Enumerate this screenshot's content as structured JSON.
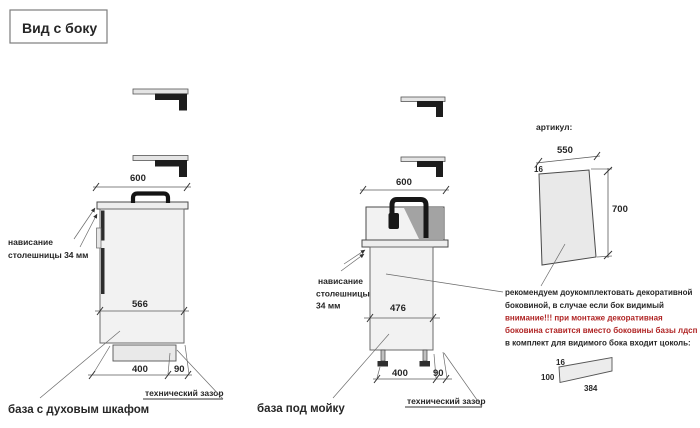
{
  "title": "Вид с боку",
  "colors": {
    "background": "#ffffff",
    "ink": "#262626",
    "warning_red": "#b02525",
    "drawing_line": "#4a4a4a",
    "cabinet_fill": "#f2f2f2",
    "dark_parts": "#1d1d1d"
  },
  "left_cabinet": {
    "label": "база с духовым шкафом",
    "dim_top": "600",
    "dim_depth": "566",
    "dim_bottom": "400",
    "dim_gap": "90",
    "overhang_line1": "нависание",
    "overhang_line2": "столешницы 34 мм",
    "tech_gap": "технический зазор"
  },
  "sink_cabinet": {
    "label": "база под мойку",
    "dim_top": "600",
    "dim_depth": "476",
    "dim_bottom": "400",
    "dim_gap": "90",
    "overhang_line1": "нависание",
    "overhang_line2": "столешницы",
    "overhang_line3": "34 мм",
    "tech_gap": "технический зазор"
  },
  "side_panel": {
    "article_label": "артикул:",
    "dim_width": "550",
    "dim_thickness": "16",
    "dim_height": "700",
    "note_line1": "рекомендуем доукомплектовать декоративной",
    "note_line2": "боковиной, в случае если бок видимый",
    "note_line3": "внимание!!! при монтаже декоративная",
    "note_line4": "боковина ставится вместо боковины базы лдсп",
    "note_line5": "в комплект для видимого бока входит цоколь:"
  },
  "plinth_panel": {
    "dim_thickness": "16",
    "dim_height": "100",
    "dim_length": "384"
  }
}
